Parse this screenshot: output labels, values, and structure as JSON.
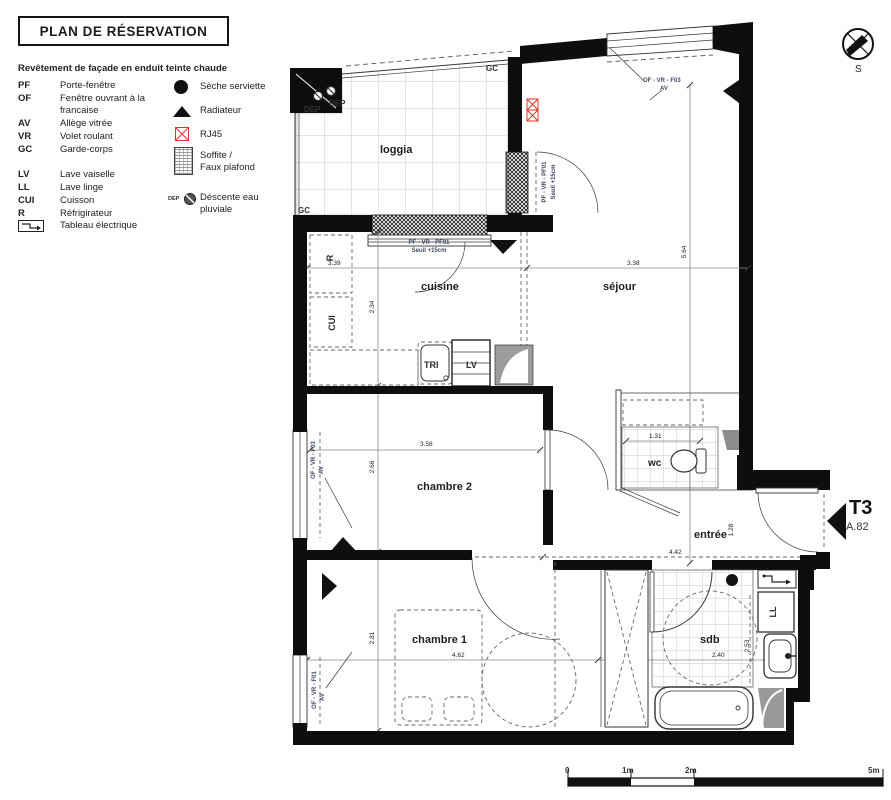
{
  "title": "PLAN DE RÉSERVATION",
  "facade_note": "Revêtement de façade en enduit teinte chaude",
  "legend": {
    "abbr": [
      {
        "k": "PF",
        "v": "Porte-fenêtre"
      },
      {
        "k": "OF",
        "v": "Fenêtre ouvrant à la",
        "v2": "francaise"
      },
      {
        "k": "AV",
        "v": "Allège vitrée"
      },
      {
        "k": "VR",
        "v": "Volet roulant"
      },
      {
        "k": "GC",
        "v": "Garde-corps"
      },
      {
        "k": "LV",
        "v": "Lave vaiselle"
      },
      {
        "k": "LL",
        "v": "Lave linge"
      },
      {
        "k": "CUI",
        "v": "Cuisson"
      },
      {
        "k": "R",
        "v": "Réfrigirateur"
      },
      {
        "k": "",
        "v": "Tableau électrique"
      }
    ],
    "symbols": [
      {
        "label": "Sèche serviette"
      },
      {
        "label": "Radiateur"
      },
      {
        "label": "RJ45"
      },
      {
        "label": "Soffite /",
        "label2": "Faux plafond"
      },
      {
        "prefix": "DEP",
        "label": "Déscente eau",
        "label2": "pluviale"
      }
    ]
  },
  "compass": {
    "south": "S"
  },
  "unit": {
    "type": "T3",
    "lot": "A.82"
  },
  "rooms": {
    "loggia": "loggia",
    "cuisine": "cuisine",
    "sejour": "séjour",
    "chambre2": "chambre 2",
    "wc": "wc",
    "entree": "entrée",
    "chambre1": "chambre 1",
    "sdb": "sdb"
  },
  "plan_labels": {
    "gc_top": "GC",
    "gc_bottom": "GC",
    "dep1": "DEP",
    "dep2": "DEP",
    "refrigerator": "R",
    "cuisson": "CUI",
    "tri": "TRI",
    "lv": "LV",
    "ll": "LL"
  },
  "openings": {
    "sejour_window": "OF - VR - F03",
    "sejour_window_av": "AV",
    "loggia_door": "PF - VR - PF01",
    "loggia_door_seuil": "Seuil +15cm",
    "cuisine_window": "PF - VR - PF01",
    "cuisine_window_seuil": "Seuil +15cm",
    "chambre2_window": "OF - VR - F03",
    "chambre2_window_av": "AV",
    "chambre1_window": "OF - VR - F01",
    "chambre1_window_av": "AV"
  },
  "dims": {
    "cuisine_w": "3.39",
    "cuisine_d": "2.34",
    "sejour_w": "3.38",
    "sejour_h": "5.64",
    "chambre2_w": "3.58",
    "chambre2_d": "2.66",
    "wc_w": "1.31",
    "wc_d": "0.90",
    "entree_h": "1.28",
    "entree_w": "4.42",
    "chambre1_d": "2.81",
    "chambre1_w": "4.62",
    "sdb_w": "2.40",
    "sdb_d": "2.53"
  },
  "scalebar": {
    "t0": "0",
    "t1": "1m",
    "t2": "2m",
    "t5": "5m"
  }
}
